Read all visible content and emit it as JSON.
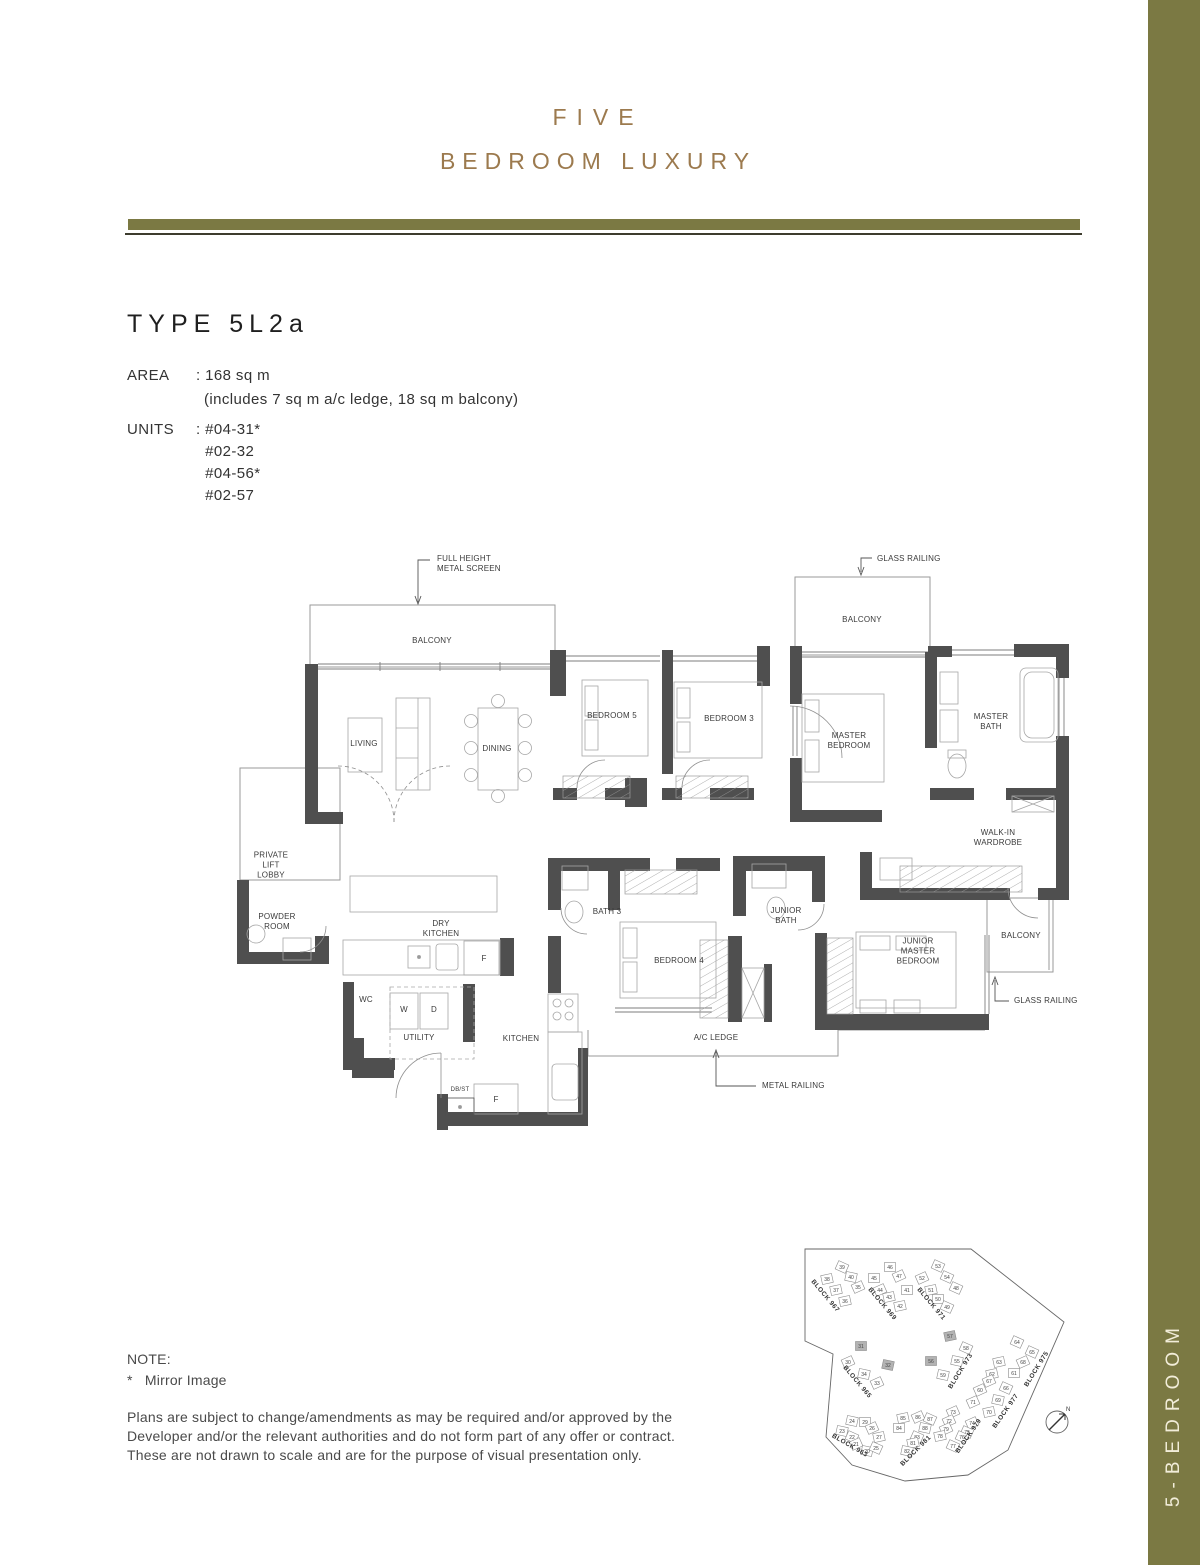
{
  "colors": {
    "gold": "#9c7a4e",
    "olive": "#7b7943",
    "wall": "#4f4f4f",
    "highlight": "#b3b3b3"
  },
  "header": {
    "title_line1": "FIVE",
    "title_line2": "BEDROOM LUXURY"
  },
  "unit": {
    "type_title": "TYPE 5L2a",
    "area_label": "AREA",
    "area_value": ": 168 sq m",
    "area_note": "(includes 7 sq m a/c ledge, 18 sq m balcony)",
    "units_label": "UNITS",
    "units": [
      ": #04-31*",
      "  #02-32",
      "  #04-56*",
      "  #02-57"
    ]
  },
  "floorplan": {
    "labels": [
      {
        "t": "BALCONY",
        "x": 432,
        "y": 641
      },
      {
        "t": "BALCONY",
        "x": 862,
        "y": 620
      },
      {
        "t": "LIVING",
        "x": 364,
        "y": 744
      },
      {
        "t": "DINING",
        "x": 497,
        "y": 749
      },
      {
        "t": "BEDROOM 5",
        "x": 612,
        "y": 716
      },
      {
        "t": "BEDROOM 3",
        "x": 729,
        "y": 719
      },
      {
        "t": "MASTER\nBEDROOM",
        "x": 849,
        "y": 741
      },
      {
        "t": "MASTER\nBATH",
        "x": 991,
        "y": 722
      },
      {
        "t": "WALK-IN\nWARDROBE",
        "x": 998,
        "y": 838
      },
      {
        "t": "PRIVATE\nLIFT\nLOBBY",
        "x": 271,
        "y": 866
      },
      {
        "t": "POWDER\nROOM",
        "x": 277,
        "y": 922
      },
      {
        "t": "DRY\nKITCHEN",
        "x": 441,
        "y": 929
      },
      {
        "t": "BATH 3",
        "x": 607,
        "y": 912
      },
      {
        "t": "JUNIOR\nBATH",
        "x": 786,
        "y": 916
      },
      {
        "t": "BEDROOM 4",
        "x": 679,
        "y": 961
      },
      {
        "t": "JUNIOR\nMASTER\nBEDROOM",
        "x": 918,
        "y": 952
      },
      {
        "t": "BALCONY",
        "x": 1021,
        "y": 936
      },
      {
        "t": "WC",
        "x": 366,
        "y": 1000
      },
      {
        "t": "W",
        "x": 404,
        "y": 1010
      },
      {
        "t": "D",
        "x": 434,
        "y": 1010
      },
      {
        "t": "UTILITY",
        "x": 419,
        "y": 1038
      },
      {
        "t": "KITCHEN",
        "x": 521,
        "y": 1039
      },
      {
        "t": "F",
        "x": 484,
        "y": 959
      },
      {
        "t": "DB/ST",
        "x": 460,
        "y": 1091,
        "s": 6
      },
      {
        "t": "F",
        "x": 496,
        "y": 1100
      },
      {
        "t": "A/C LEDGE",
        "x": 716,
        "y": 1038
      }
    ],
    "annotations": [
      {
        "t": "FULL HEIGHT\nMETAL SCREEN",
        "x": 437,
        "y": 564,
        "a": "l"
      },
      {
        "t": "GLASS RAILING",
        "x": 877,
        "y": 559,
        "a": "l"
      },
      {
        "t": "GLASS RAILING",
        "x": 1014,
        "y": 1001,
        "a": "l"
      },
      {
        "t": "METAL RAILING",
        "x": 762,
        "y": 1086,
        "a": "l"
      }
    ]
  },
  "site_plan": {
    "compass_label": "N",
    "blocks": [
      {
        "name": "BLOCK 967",
        "x": 824,
        "y": 1297,
        "r": 50
      },
      {
        "name": "BLOCK 969",
        "x": 881,
        "y": 1305,
        "r": 50
      },
      {
        "name": "BLOCK 971",
        "x": 930,
        "y": 1305,
        "r": 50
      },
      {
        "name": "BLOCK 965",
        "x": 856,
        "y": 1383,
        "r": 50
      },
      {
        "name": "BLOCK 973",
        "x": 962,
        "y": 1372,
        "r": -58
      },
      {
        "name": "BLOCK 975",
        "x": 1038,
        "y": 1370,
        "r": -58
      },
      {
        "name": "BLOCK 977",
        "x": 1007,
        "y": 1412,
        "r": -55
      },
      {
        "name": "BLOCK 979",
        "x": 970,
        "y": 1437,
        "r": -55
      },
      {
        "name": "BLOCK 981",
        "x": 917,
        "y": 1452,
        "r": -45
      },
      {
        "name": "BLOCK 963",
        "x": 849,
        "y": 1447,
        "r": 30
      }
    ],
    "units": [
      {
        "n": "39",
        "x": 842,
        "y": 1267
      },
      {
        "n": "40",
        "x": 851,
        "y": 1277
      },
      {
        "n": "38",
        "x": 827,
        "y": 1279
      },
      {
        "n": "37",
        "x": 836,
        "y": 1290
      },
      {
        "n": "35",
        "x": 858,
        "y": 1287
      },
      {
        "n": "36",
        "x": 845,
        "y": 1301
      },
      {
        "n": "46",
        "x": 890,
        "y": 1267
      },
      {
        "n": "47",
        "x": 899,
        "y": 1276
      },
      {
        "n": "45",
        "x": 874,
        "y": 1278
      },
      {
        "n": "44",
        "x": 880,
        "y": 1290
      },
      {
        "n": "43",
        "x": 889,
        "y": 1297
      },
      {
        "n": "41",
        "x": 907,
        "y": 1290
      },
      {
        "n": "42",
        "x": 900,
        "y": 1306
      },
      {
        "n": "53",
        "x": 938,
        "y": 1266
      },
      {
        "n": "54",
        "x": 947,
        "y": 1277
      },
      {
        "n": "52",
        "x": 922,
        "y": 1278
      },
      {
        "n": "51",
        "x": 931,
        "y": 1290
      },
      {
        "n": "48",
        "x": 956,
        "y": 1288
      },
      {
        "n": "50",
        "x": 938,
        "y": 1299
      },
      {
        "n": "49",
        "x": 947,
        "y": 1307
      },
      {
        "n": "31",
        "x": 861,
        "y": 1346,
        "h": true
      },
      {
        "n": "30",
        "x": 848,
        "y": 1362
      },
      {
        "n": "32",
        "x": 888,
        "y": 1365,
        "h": true
      },
      {
        "n": "34",
        "x": 864,
        "y": 1374
      },
      {
        "n": "33",
        "x": 877,
        "y": 1383
      },
      {
        "n": "57",
        "x": 950,
        "y": 1336,
        "h": true
      },
      {
        "n": "58",
        "x": 966,
        "y": 1348
      },
      {
        "n": "56",
        "x": 931,
        "y": 1361,
        "h": true
      },
      {
        "n": "55",
        "x": 957,
        "y": 1361
      },
      {
        "n": "59",
        "x": 943,
        "y": 1375
      },
      {
        "n": "64",
        "x": 1017,
        "y": 1342
      },
      {
        "n": "65",
        "x": 1032,
        "y": 1352
      },
      {
        "n": "63",
        "x": 999,
        "y": 1362
      },
      {
        "n": "68",
        "x": 1023,
        "y": 1362
      },
      {
        "n": "62",
        "x": 992,
        "y": 1374
      },
      {
        "n": "61",
        "x": 1014,
        "y": 1373
      },
      {
        "n": "67",
        "x": 989,
        "y": 1381
      },
      {
        "n": "66",
        "x": 1006,
        "y": 1388
      },
      {
        "n": "60",
        "x": 980,
        "y": 1390
      },
      {
        "n": "69",
        "x": 998,
        "y": 1400
      },
      {
        "n": "71",
        "x": 973,
        "y": 1402
      },
      {
        "n": "70",
        "x": 989,
        "y": 1412
      },
      {
        "n": "73",
        "x": 953,
        "y": 1412
      },
      {
        "n": "72",
        "x": 949,
        "y": 1421
      },
      {
        "n": "74",
        "x": 972,
        "y": 1423
      },
      {
        "n": "79",
        "x": 946,
        "y": 1429
      },
      {
        "n": "75",
        "x": 967,
        "y": 1432
      },
      {
        "n": "78",
        "x": 940,
        "y": 1436
      },
      {
        "n": "76",
        "x": 962,
        "y": 1437
      },
      {
        "n": "77",
        "x": 953,
        "y": 1446
      },
      {
        "n": "85",
        "x": 903,
        "y": 1418
      },
      {
        "n": "86",
        "x": 918,
        "y": 1417
      },
      {
        "n": "87",
        "x": 930,
        "y": 1419
      },
      {
        "n": "84",
        "x": 899,
        "y": 1428
      },
      {
        "n": "88",
        "x": 925,
        "y": 1428
      },
      {
        "n": "83",
        "x": 917,
        "y": 1437
      },
      {
        "n": "81",
        "x": 913,
        "y": 1443
      },
      {
        "n": "82",
        "x": 907,
        "y": 1451
      },
      {
        "n": "24",
        "x": 852,
        "y": 1421
      },
      {
        "n": "29",
        "x": 865,
        "y": 1422
      },
      {
        "n": "23",
        "x": 842,
        "y": 1431
      },
      {
        "n": "26",
        "x": 872,
        "y": 1428
      },
      {
        "n": "22",
        "x": 852,
        "y": 1437
      },
      {
        "n": "27",
        "x": 879,
        "y": 1437
      },
      {
        "n": "21",
        "x": 856,
        "y": 1444
      },
      {
        "n": "20",
        "x": 867,
        "y": 1451
      },
      {
        "n": "25",
        "x": 876,
        "y": 1448
      }
    ]
  },
  "notes": {
    "heading": "NOTE:",
    "mirror": "*   Mirror Image",
    "disclaimer": [
      "Plans are subject to change/amendments as may be required and/or approved by the",
      "Developer and/or the relevant authorities and do not form part of any offer or contract.",
      "These are not drawn to scale and are for the purpose of visual presentation only."
    ]
  },
  "side_tab": {
    "label": "5-BEDROOM"
  }
}
